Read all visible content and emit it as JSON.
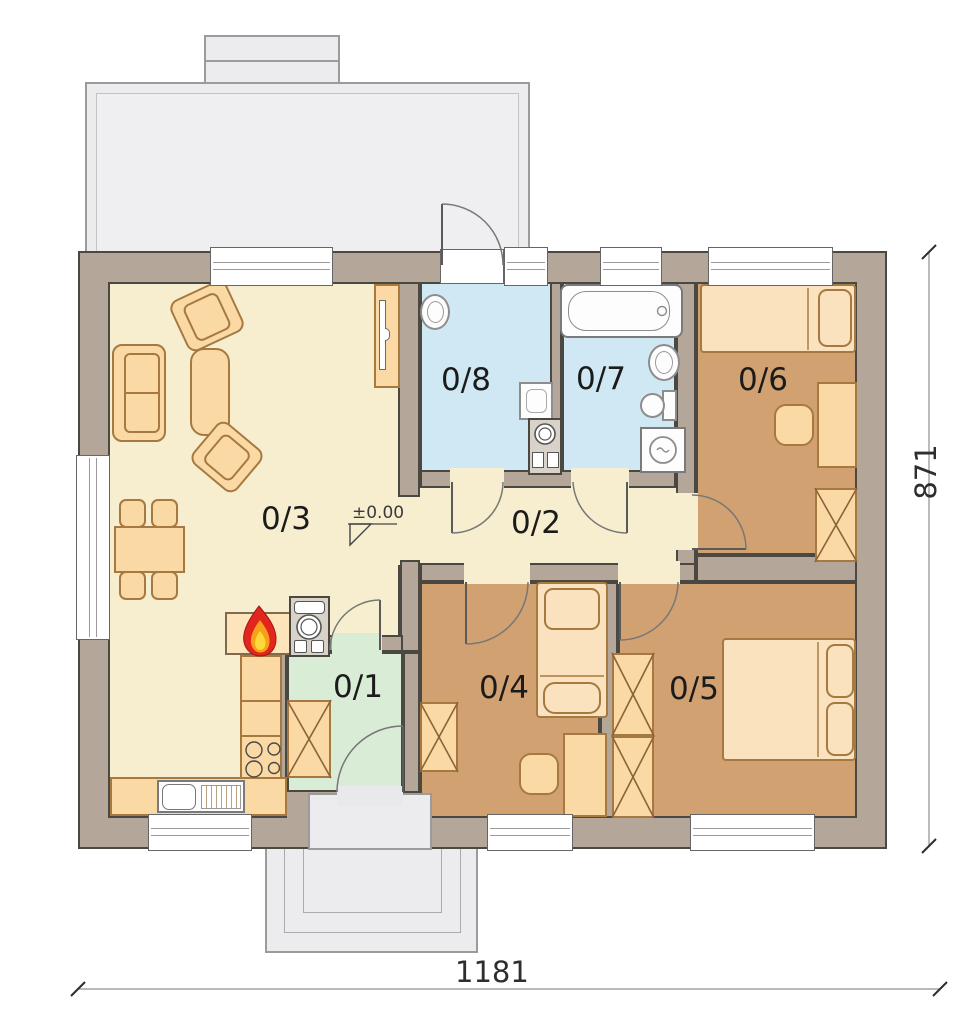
{
  "title": "Single-storey house floor plan",
  "rooms": [
    {
      "label": "0/1",
      "type": "entry-vestibule",
      "floor_color": "#d9edd6"
    },
    {
      "label": "0/2",
      "type": "hallway",
      "floor_color": "#f7eed0"
    },
    {
      "label": "0/3",
      "type": "living-room-kitchen",
      "floor_color": "#f7eed0"
    },
    {
      "label": "0/4",
      "type": "bedroom",
      "floor_color": "#d2a172"
    },
    {
      "label": "0/5",
      "type": "bedroom",
      "floor_color": "#d2a172"
    },
    {
      "label": "0/6",
      "type": "bedroom",
      "floor_color": "#d2a172"
    },
    {
      "label": "0/7",
      "type": "bathroom",
      "floor_color": "#cfe8f3"
    },
    {
      "label": "0/8",
      "type": "utility-room",
      "floor_color": "#cfe8f3"
    }
  ],
  "annotations": {
    "level_mark": "±0.00",
    "width_dim": "1181",
    "height_dim": "871"
  },
  "icons": {
    "fireplace": "flame-icon",
    "wardrobe": "x-cross-box",
    "stove": "four-burner-circles"
  },
  "colors": {
    "wall": "#b4a79a",
    "wall_outline": "#4b4741",
    "living_floor": "#f7eed0",
    "bedroom_floor": "#d2a172",
    "bathroom_floor": "#cfe8f3",
    "entry_floor": "#d9edd6",
    "furniture": "#fbd9a5",
    "furniture_outline": "#a5793f",
    "terrace": "#ececee",
    "flame_red": "#e3261d",
    "flame_yellow": "#ffd93b"
  }
}
